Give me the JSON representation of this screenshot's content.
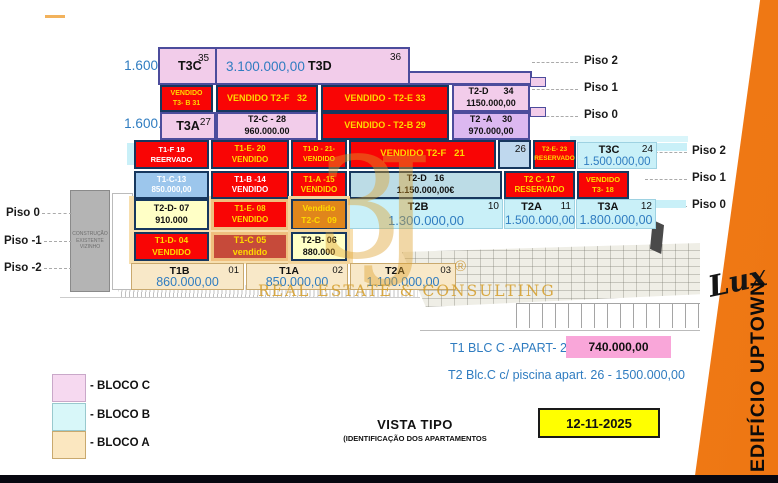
{
  "palette": {
    "sold_red": "#F90505",
    "sold_text_yellow": "#FFD900",
    "bloco_c_pink": "#F2CCEA",
    "unit_purple": "#DCB8F0",
    "bloco_b_cyan": "#C9F0F8",
    "light_blue": "#9CC6EC",
    "blue_gray": "#BCDCE6",
    "pale_yellow": "#FFFFC6",
    "unit_orange": "#E0861B",
    "brick_red": "#C64A3A",
    "bloco_a_tan": "#F8E8C8",
    "price_blue": "#2F7CC0",
    "accent_orange": "#F1821E",
    "date_yellow": "#FFFF00",
    "note_pink": "#F9A6D9",
    "watermark_gold": "#D79A2B"
  },
  "prices_left": {
    "top": "1.600.000,00",
    "bottom": "1.600.000,00"
  },
  "units": {
    "t3c35": {
      "label": "T3C",
      "num": "35"
    },
    "t3d36": {
      "price": "3.100.000,00",
      "label": "T3D",
      "num": "36"
    },
    "t3b31": {
      "l1": "VENDIDO",
      "l2": "T3- B 31"
    },
    "t2f32": {
      "l1": "VENDIDO T2-F   32"
    },
    "t2e33": {
      "l1": "VENDIDO - T2-E 33"
    },
    "t2d34": {
      "l1": "T2-D      34",
      "l2": "1150.000,00"
    },
    "t3a27": {
      "label": "T3A",
      "num": "27"
    },
    "t2c28": {
      "l1": "T2-C - 28",
      "l2": "960.000.00"
    },
    "t2b29": {
      "l1": "VENDIDO - T2-B 29"
    },
    "t2a30": {
      "l1": "T2 -A    30",
      "l2": "970.000,00"
    },
    "t1f19": {
      "l1": "T1-F 19",
      "l2": "REERVADO"
    },
    "t1e20": {
      "l1": "T1-E- 20",
      "l2": "VENDIDO"
    },
    "t1d21": {
      "l1": "T1-D - 21-",
      "l2": "VENDIDO"
    },
    "t2f21": {
      "l1": "VENDIDO T2-F   21"
    },
    "u26": {
      "num": "26"
    },
    "t2e23": {
      "l1": "T2-E- 23",
      "l2": "RESERVADO"
    },
    "t3c24": {
      "label": "T3C",
      "num": "24",
      "price": "1.500.000,00"
    },
    "t1c13": {
      "l1": "T1-C-13",
      "l2": "850.000,00"
    },
    "t1b14": {
      "l1": "T1-B -14",
      "l2": "VENDIDO"
    },
    "t1a15": {
      "l1": "T1-A -15",
      "l2": "VENDIDO"
    },
    "t2d16": {
      "l1": "T2-D   16",
      "l2": "1.150.000,00€"
    },
    "t2c17": {
      "l1": "T2 C- 17",
      "l2": "RESERVADO"
    },
    "t318": {
      "l1": "VENDIDO",
      "l2": "T3- 18"
    },
    "t2d07": {
      "l1": "T2-D- 07",
      "l2": "910.000"
    },
    "t1e08": {
      "l1": "T1-E- 08",
      "l2": "VENDIDO"
    },
    "t2c09": {
      "l1": "Vendido",
      "l2": "T2-C   09"
    },
    "t2b10": {
      "label": "T2B",
      "num": "10",
      "price": "1.300.000,00"
    },
    "t2a11": {
      "label": "T2A",
      "num": "11",
      "price": "1.500.000,00"
    },
    "t3a12": {
      "label": "T3A",
      "num": "12",
      "price": "1.800.000,00"
    },
    "t1d04": {
      "l1": "T1-D- 04",
      "l2": "VENDIDO"
    },
    "t1c05": {
      "l1": "T1-C 05",
      "l2": "vendido"
    },
    "t2b06": {
      "l1": "T2-B- 06",
      "l2": "880.000"
    },
    "t1b01": {
      "label": "T1B",
      "num": "01",
      "price": "860.000,00"
    },
    "t1a02": {
      "label": "T1A",
      "num": "02",
      "price": "850.000,00"
    },
    "t2a03": {
      "label": "T2A",
      "num": "03",
      "price": "1.100.000,00"
    }
  },
  "floors": {
    "left": [
      "Piso 0",
      "Piso -1",
      "Piso -2"
    ],
    "right_upper": [
      "Piso 2",
      "Piso 1",
      "Piso 0"
    ],
    "right_lower": [
      "Piso 2",
      "Piso 1",
      "Piso 0"
    ]
  },
  "neighbor_note": "CONSTRUÇÃO EXISTENTE VIZINHO",
  "legend": [
    {
      "label": "- BLOCO C",
      "color": "#F6D9F0"
    },
    {
      "label": "- BLOCO B",
      "color": "#D8F7F9"
    },
    {
      "label": "- BLOCO A",
      "color": "#FBE7C0"
    }
  ],
  "notes": {
    "line1_text": "T1 BLC C -APART- 25-",
    "line1_price": "740.000,00",
    "line2_text": "T2 Blc.C c/ piscina apart. 26 - 1500.000,00"
  },
  "caption": {
    "title": "VISTA TIPO",
    "subtitle": "(IDENTIFICAÇÃO DOS APARTAMENTOS"
  },
  "date_box": "12-11-2025",
  "sidebar": {
    "brand": "Lux",
    "building": "EDIFÍCIO UPTOWN"
  },
  "watermark": {
    "logo": "3J",
    "reg": "®",
    "text": "REAL ESTATE & CONSULTING"
  }
}
